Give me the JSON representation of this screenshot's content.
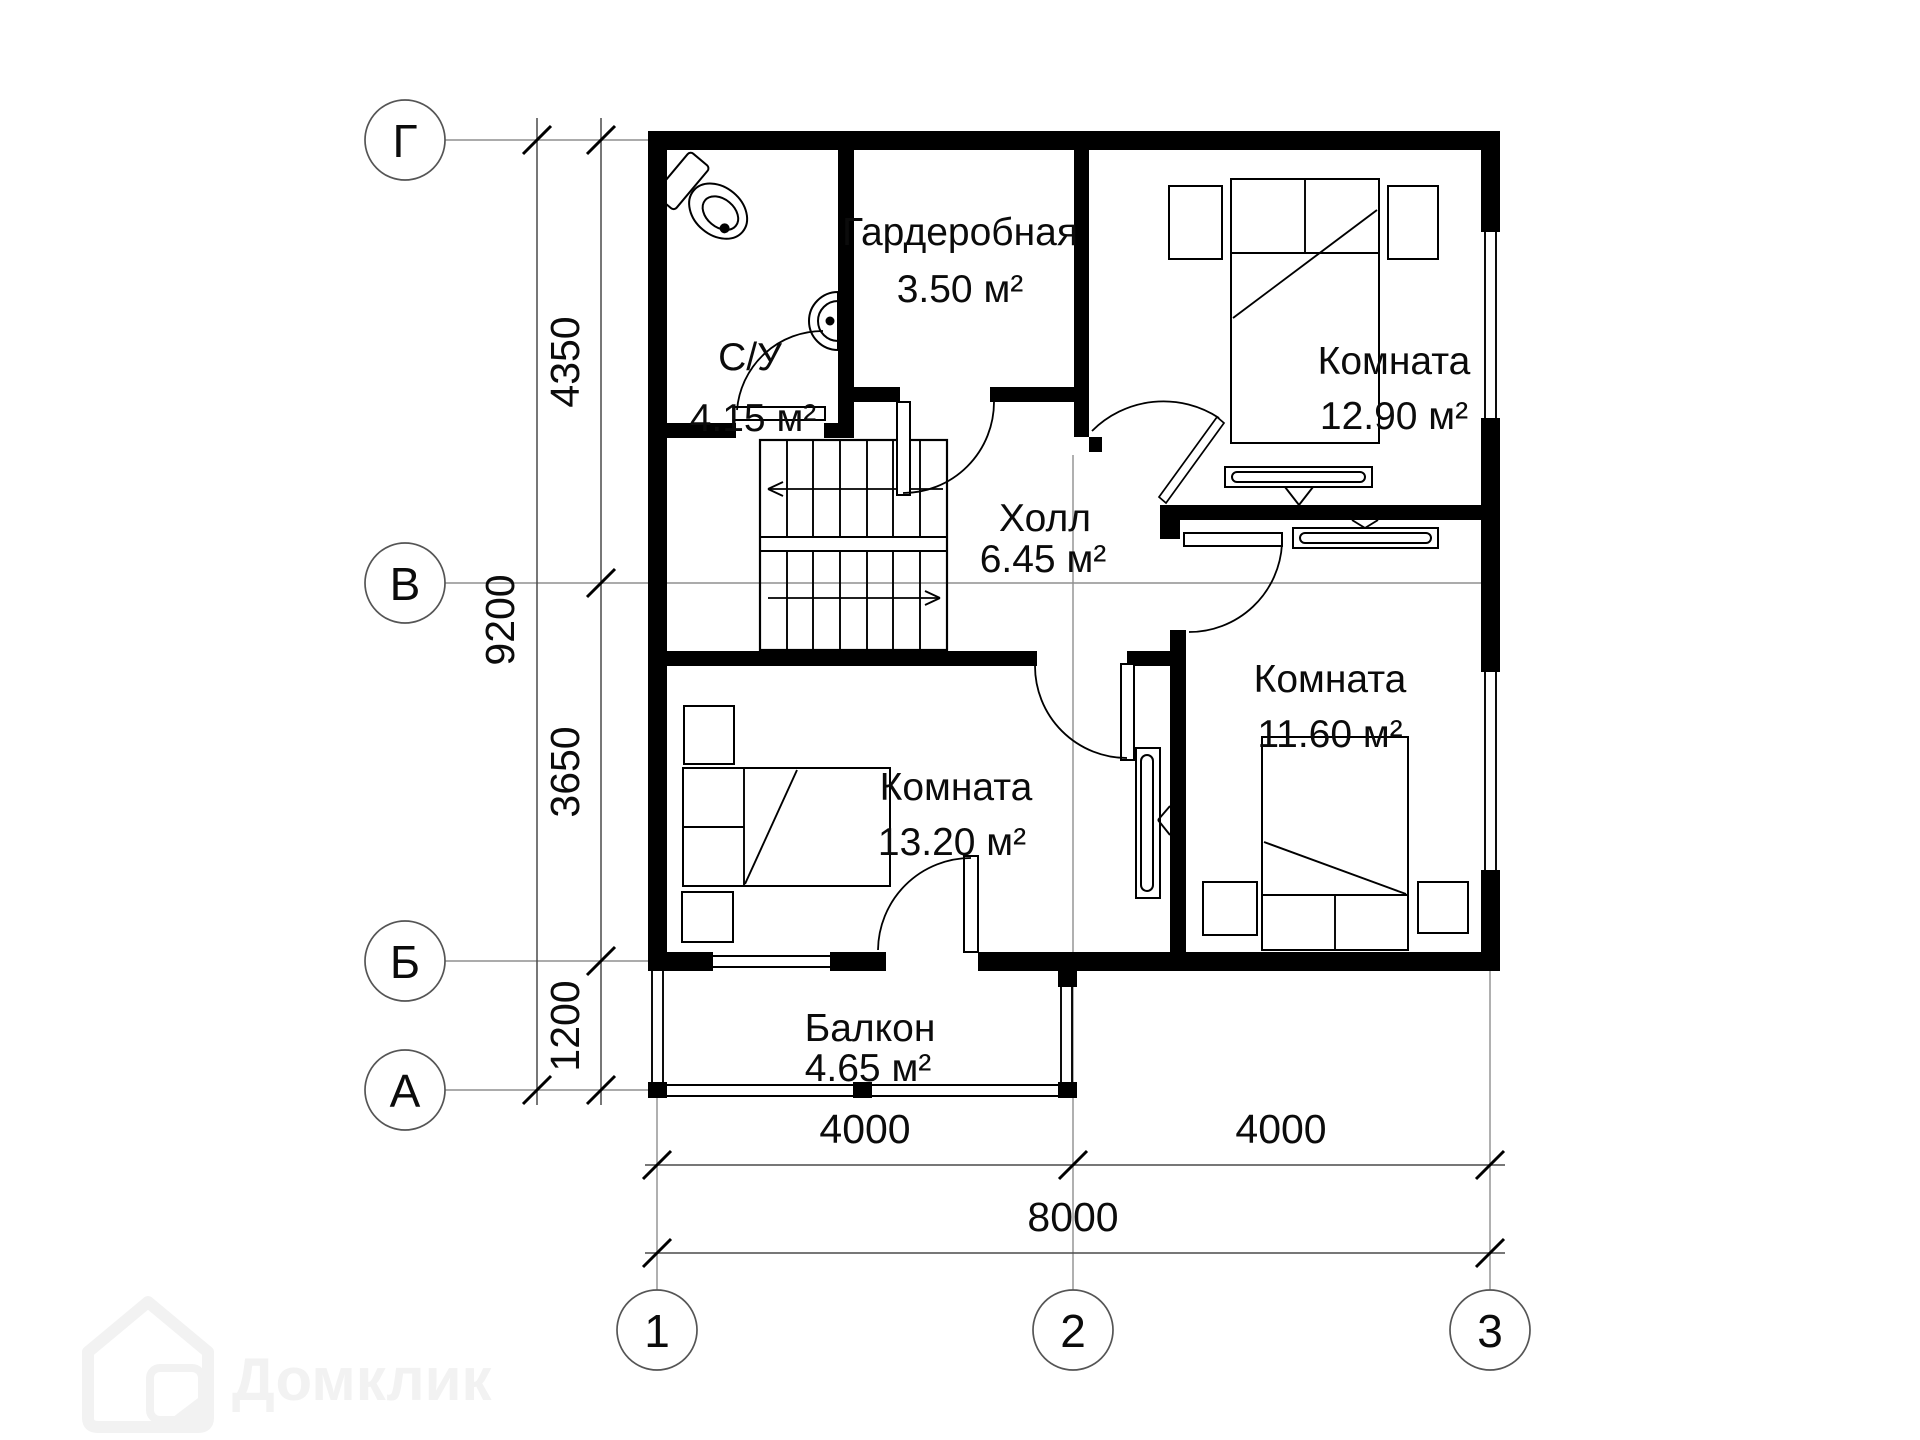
{
  "plan": {
    "rooms": {
      "wc": {
        "name": "С/У",
        "area": "4.15 м²"
      },
      "wardrobe": {
        "name": "Гардеробная",
        "area": "3.50 м²"
      },
      "bedroom_top_right": {
        "name": "Комната",
        "area": "12.90 м²"
      },
      "hall": {
        "name": "Холл",
        "area": "6.45 м²"
      },
      "bedroom_bot_right": {
        "name": "Комната",
        "area": "11.60 м²"
      },
      "bedroom_bot_left": {
        "name": "Комната",
        "area": "13.20 м²"
      },
      "balcony": {
        "name": "Балкон",
        "area": "4.65 м²"
      }
    },
    "axis_labels": {
      "rows": [
        "Г",
        "В",
        "Б",
        "А"
      ],
      "cols": [
        "1",
        "2",
        "3"
      ]
    },
    "dimensions": {
      "row_spans": [
        "4350",
        "3650",
        "1200"
      ],
      "row_total": "9200",
      "col_spans": [
        "4000",
        "4000"
      ],
      "col_total": "8000"
    },
    "icons": {
      "furniture": [
        "double-bed-icon",
        "nightstand-icon",
        "toilet-icon",
        "sink-icon",
        "radiator-icon",
        "stairs-icon",
        "door-swing-icon",
        "window-icon",
        "balcony-railing-icon"
      ]
    },
    "colors": {
      "wall": "#000000",
      "background": "#ffffff",
      "dimension_line": "#4a4a4a",
      "axis_line": "#8f8f8f",
      "watermark": "#f2f2f2"
    }
  },
  "watermark": {
    "label": "Домклик"
  }
}
